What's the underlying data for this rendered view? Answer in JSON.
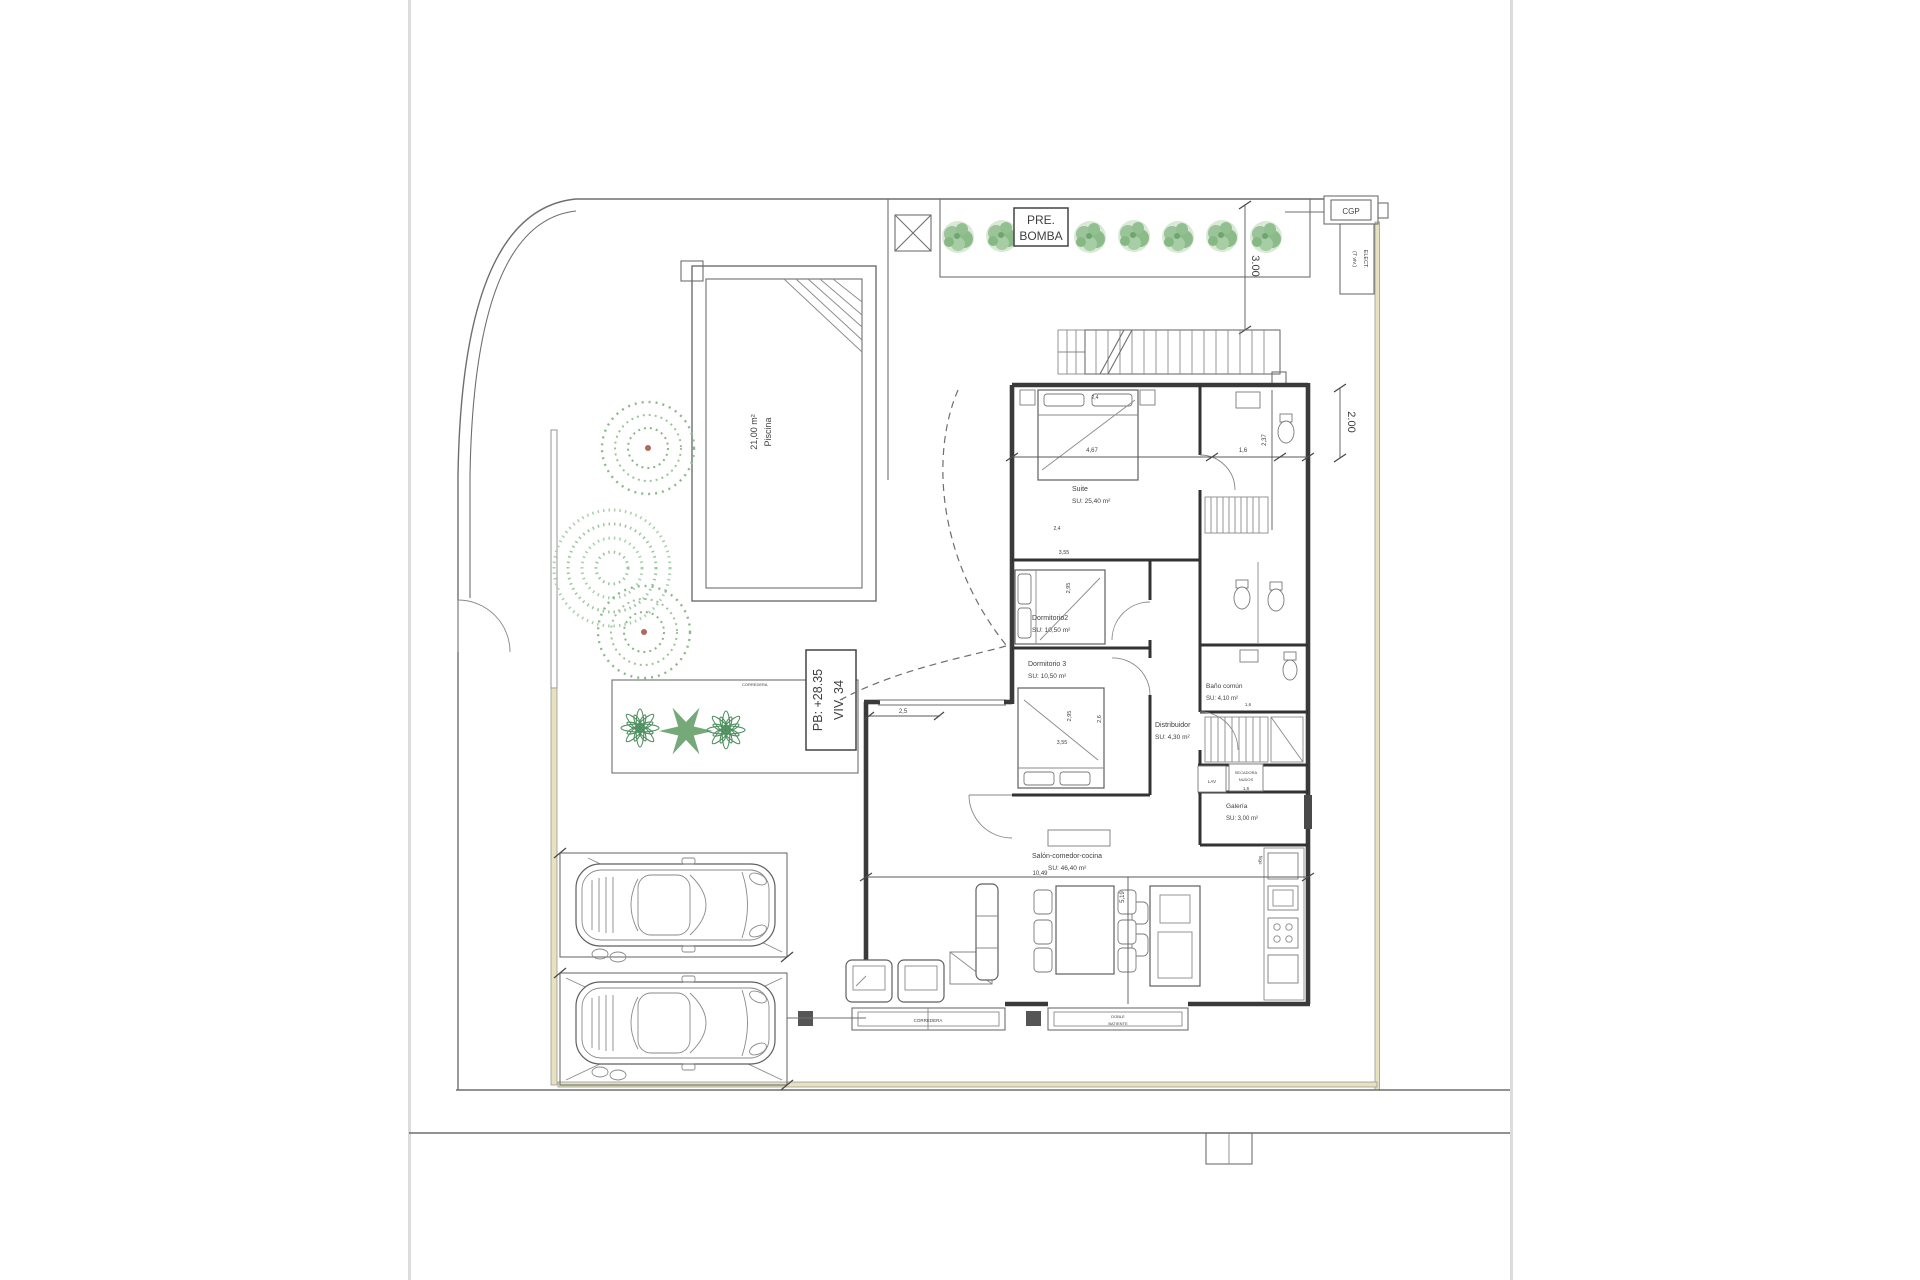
{
  "drawing": {
    "pre_bomba": {
      "line1": "PRE.",
      "line2": "BOMBA"
    },
    "cgp": "CGP",
    "elect": {
      "line1": "ELECT.",
      "line2": "(7 viv.)"
    },
    "dims": {
      "top_setback": "3.00",
      "right_setback": "2.00",
      "suite_width": "4,67",
      "bath_width": "1,6",
      "bath_depth": "2,37",
      "bed_width": "2,4",
      "dorm_width": "3,55",
      "dorm_depth": "2,95",
      "dorm3_width": "2,6",
      "terrace_width": "2,5",
      "salon_width": "10,49",
      "salon_depth": "5,19",
      "laundry_width": "1,6",
      "bano_width": "1,6"
    },
    "pool": {
      "line1": "Piscina",
      "line2": "21,00 m²"
    },
    "viv": {
      "line1": "VIV. 34",
      "line2": "PB: +28.35"
    },
    "rooms": {
      "suite": {
        "name": "Suite",
        "area": "SU: 25,40 m²"
      },
      "dorm2": {
        "name": "Dormitorio2",
        "area": "SU: 10,50 m²"
      },
      "dorm3": {
        "name": "Dormitorio 3",
        "area": "SU: 10,50 m²"
      },
      "distribuidor": {
        "name": "Distribuidor",
        "area": "SU: 4,30 m²"
      },
      "bano_comun": {
        "name": "Baño común",
        "area": "SU: 4,10 m²"
      },
      "galeria": {
        "name": "Galería",
        "area": "SU: 3,00 m²"
      },
      "salon": {
        "name": "Salón-comedor-cocina",
        "area": "SU: 46,40 m²"
      }
    },
    "annotations": {
      "lav": "LAV",
      "secadora_line1": "SECADORA",
      "secadora_line2": "NUDOS",
      "frigo": "frigo",
      "corredera": "CORREDERA",
      "batiente_line1": "DOBLE",
      "batiente_line2": "BATIENTE"
    },
    "colors": {
      "wall": "#3a3a3a",
      "line": "#6e6e6e",
      "plant_green": "#6fa56f",
      "boundary_yellow": "#e7e2bd",
      "page_edge": "#dcdcdc"
    }
  }
}
